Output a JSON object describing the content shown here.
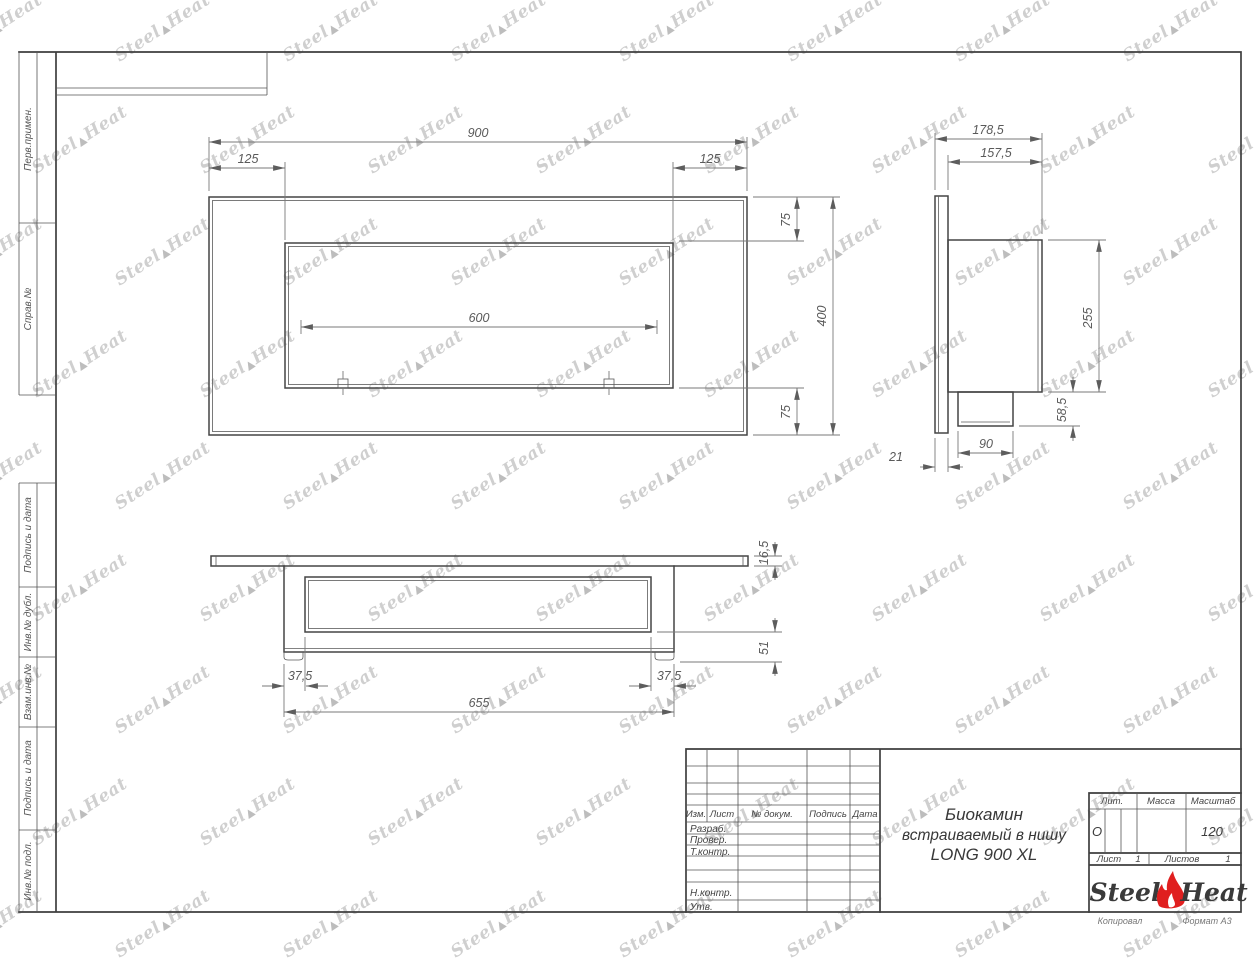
{
  "margin_labels": [
    "Перв.примен.",
    "Справ.№",
    "Подпись и дата",
    "Инв.№ дубл.",
    "Взам.инв.№",
    "Подпись и дата",
    "Инв.№ подл."
  ],
  "views": {
    "front": {
      "dims": {
        "overall_width": "900",
        "left_inset": "125",
        "right_inset": "125",
        "burner_length": "600",
        "top_margin": "75",
        "bottom_margin": "75",
        "overall_height": "400"
      }
    },
    "side": {
      "dims": {
        "overall_depth": "178,5",
        "body_depth": "157,5",
        "body_height": "255",
        "tray_height": "58,5",
        "tray_depth": "90",
        "flange_thickness": "21"
      }
    },
    "bottom": {
      "dims": {
        "flange_thickness": "16,5",
        "tray_drop": "51",
        "left_foot_offset": "37,5",
        "right_foot_offset": "37,5",
        "body_width": "655"
      }
    }
  },
  "title_block": {
    "change_cols": {
      "izm": "Изм.",
      "list": "Лист",
      "doc": "№ докум.",
      "sign": "Подпись",
      "date": "Дата"
    },
    "role_rows": {
      "razrab": "Разраб.",
      "prover": "Провер.",
      "tkontr": "Т.контр.",
      "nkontr": "Н.контр.",
      "utv": "Утв."
    },
    "title_line1": "Биокамин",
    "title_line2": "встраиваемый в нишу",
    "title_line3": "LONG 900 XL",
    "lit_label": "Лит.",
    "lit_value": "О",
    "mass_label": "Масса",
    "scale_label": "Масштаб",
    "scale_value": "120",
    "sheet_label": "Лист",
    "sheet_value": "1",
    "sheets_label": "Листов",
    "sheets_value": "1",
    "brand_left": "Steel",
    "brand_right": "Heat",
    "footer_copy": "Копировал",
    "footer_format": "Формат А3"
  },
  "watermark": {
    "left": "Steel",
    "right": "Heat",
    "flame": "▲"
  },
  "colors": {
    "line": "#454545",
    "dim": "#7a7a7a",
    "flame_red": "#e01f1f",
    "watermark": "#cfcfcf"
  }
}
